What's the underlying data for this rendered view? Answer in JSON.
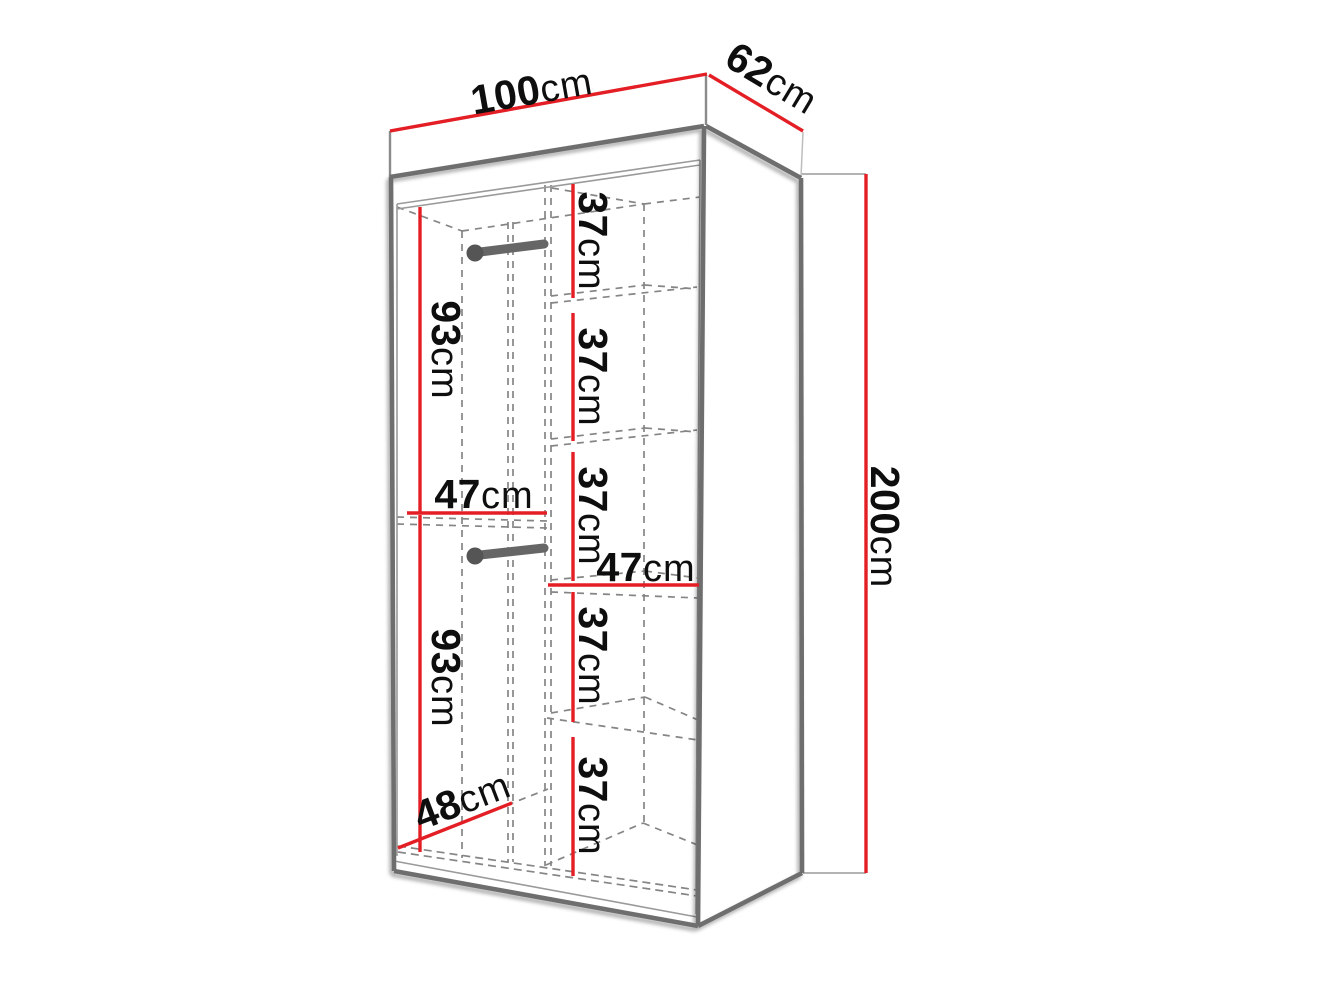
{
  "diagram": {
    "title": "wardrobe-dimension-diagram",
    "object": "two-door wardrobe with side shelves and two hanging rails",
    "colors": {
      "dimension_line": "#e31e24",
      "outline": "#6e6e6e",
      "hidden_line": "#858585",
      "text": "#0e0e0e",
      "background": "#ffffff"
    }
  },
  "labels": {
    "width_top": {
      "value": "100",
      "unit": "cm",
      "meaning": "overall width"
    },
    "depth_top": {
      "value": "62",
      "unit": "cm",
      "meaning": "overall depth"
    },
    "height_right": {
      "value": "200",
      "unit": "cm",
      "meaning": "overall height"
    },
    "shelf_gaps": [
      {
        "value": "37",
        "unit": "cm"
      },
      {
        "value": "37",
        "unit": "cm"
      },
      {
        "value": "37",
        "unit": "cm"
      },
      {
        "value": "37",
        "unit": "cm"
      },
      {
        "value": "37",
        "unit": "cm"
      }
    ],
    "hang_heights": [
      {
        "value": "93",
        "unit": "cm"
      },
      {
        "value": "93",
        "unit": "cm"
      }
    ],
    "section_widths": [
      {
        "value": "47",
        "unit": "cm"
      },
      {
        "value": "47",
        "unit": "cm"
      }
    ],
    "bottom_depth": {
      "value": "48",
      "unit": "cm"
    }
  }
}
